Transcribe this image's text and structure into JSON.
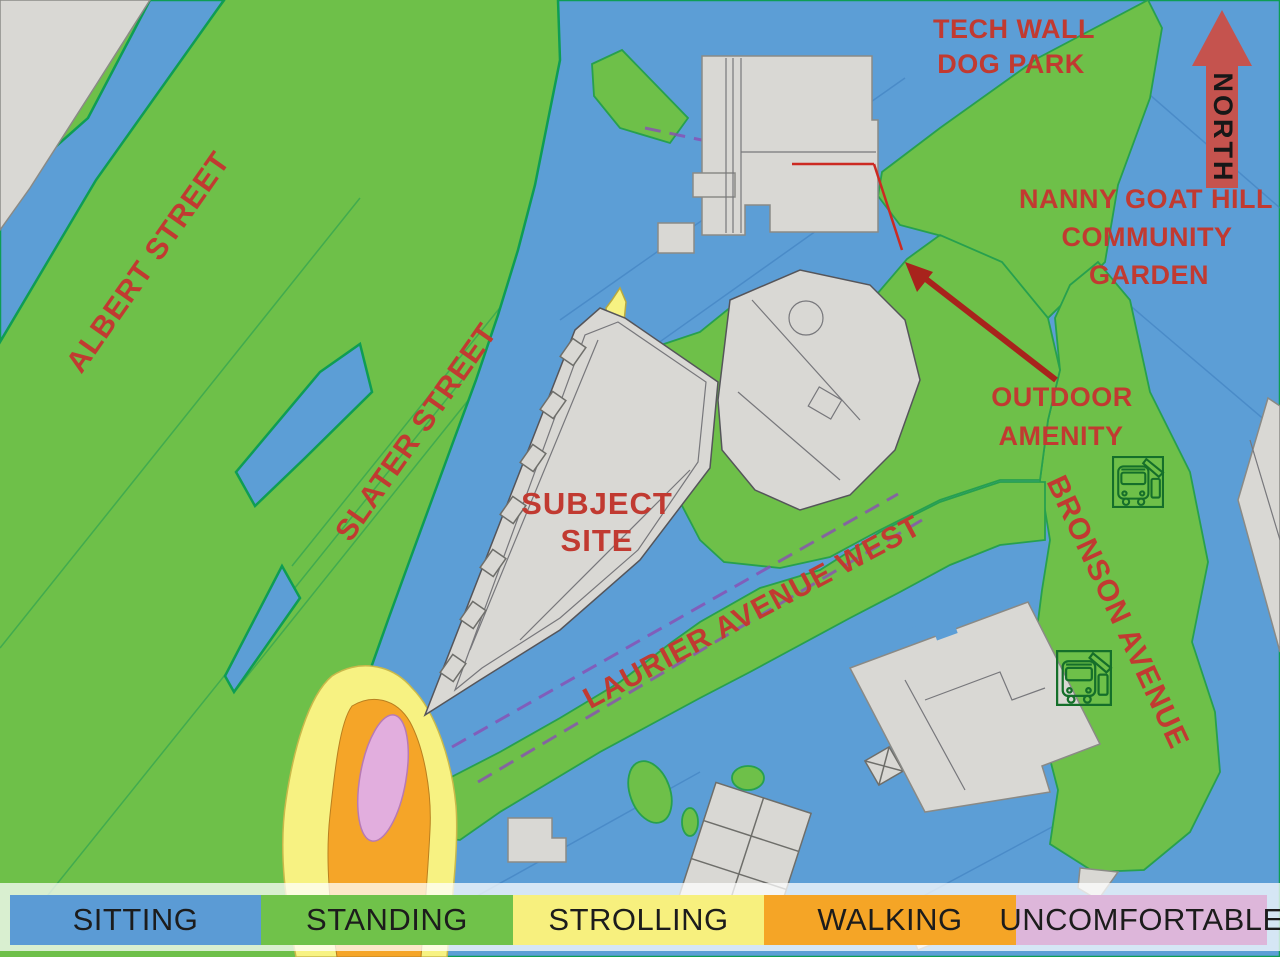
{
  "map": {
    "title_hint": "Pedestrian wind comfort map",
    "labels": {
      "albert_street": "ALBERT STREET",
      "slater_street": "SLATER STREET",
      "laurier_avenue_west": "LAURIER AVENUE WEST",
      "bronson_avenue": "BRONSON AVENUE",
      "subject_site_line1": "SUBJECT",
      "subject_site_line2": "SITE",
      "tech_wall_line1": "TECH WALL",
      "tech_wall_line2": "DOG PARK",
      "nanny_line1": "NANNY GOAT HILL",
      "nanny_line2": "COMMUNITY",
      "nanny_line3": "GARDEN",
      "outdoor_line1": "OUTDOOR",
      "outdoor_line2": "AMENITY",
      "north": "NORTH"
    },
    "colors": {
      "label_red": "#c13a31",
      "north_arrow_red": "#c5534e",
      "pointer_arrow_red": "#a8231c"
    }
  },
  "legend": {
    "items": [
      {
        "label": "SITTING",
        "color": "#5b9bd5"
      },
      {
        "label": "STANDING",
        "color": "#70c24a"
      },
      {
        "label": "STROLLING",
        "color": "#f7f07e"
      },
      {
        "label": "WALKING",
        "color": "#f5a526"
      },
      {
        "label": "UNCOMFORTABLE",
        "color": "#ddb6da"
      }
    ]
  }
}
